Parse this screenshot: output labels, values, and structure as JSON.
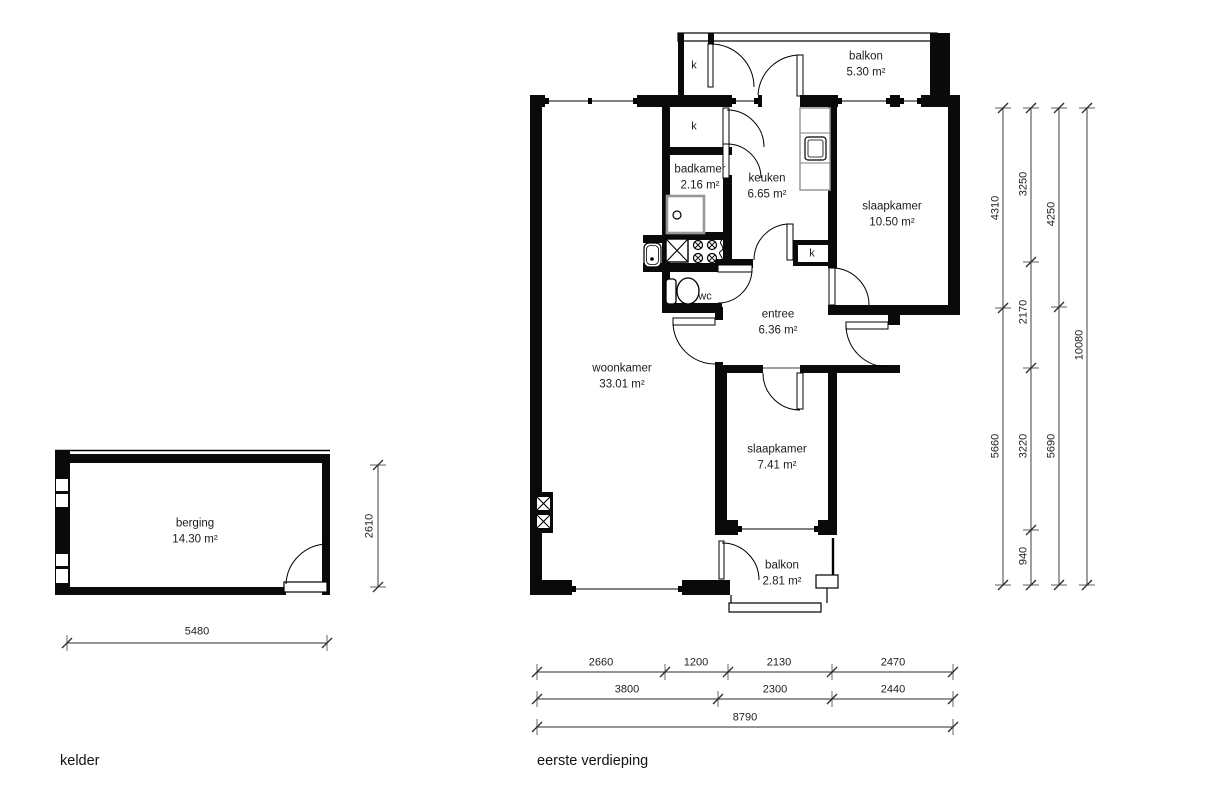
{
  "plans": {
    "kelder": {
      "caption": "kelder",
      "rooms": [
        {
          "name": "berging",
          "area": "14.30 m²"
        }
      ],
      "dims": [
        {
          "value": "5480"
        },
        {
          "value": "2610"
        }
      ]
    },
    "eerste_verdieping": {
      "caption": "eerste verdieping",
      "rooms": [
        {
          "name": "balkon",
          "area": "5.30 m²"
        },
        {
          "name": "badkamer",
          "area": "2.16 m²"
        },
        {
          "name": "keuken",
          "area": "6.65 m²"
        },
        {
          "name": "slaapkamer",
          "area": "10.50 m²"
        },
        {
          "name": "entree",
          "area": "6.36 m²"
        },
        {
          "name": "woonkamer",
          "area": "33.01 m²"
        },
        {
          "name": "slaapkamer",
          "area": "7.41 m²"
        },
        {
          "name": "balkon",
          "area": "2.81 m²"
        }
      ],
      "labels": {
        "wc": "wc",
        "closet": "k"
      },
      "dims_vertical": [
        {
          "value": "4310"
        },
        {
          "value": "3250"
        },
        {
          "value": "4250"
        },
        {
          "value": "2170"
        },
        {
          "value": "10080"
        },
        {
          "value": "5660"
        },
        {
          "value": "3220"
        },
        {
          "value": "5690"
        },
        {
          "value": "940"
        }
      ],
      "dims_horizontal": [
        {
          "value": "2660"
        },
        {
          "value": "1200"
        },
        {
          "value": "2130"
        },
        {
          "value": "2470"
        },
        {
          "value": "3800"
        },
        {
          "value": "2300"
        },
        {
          "value": "2440"
        },
        {
          "value": "8790"
        }
      ]
    }
  },
  "colors": {
    "wall": "#0a0a0a",
    "fixture": "#979797",
    "dimline": "#2b2b2b"
  }
}
